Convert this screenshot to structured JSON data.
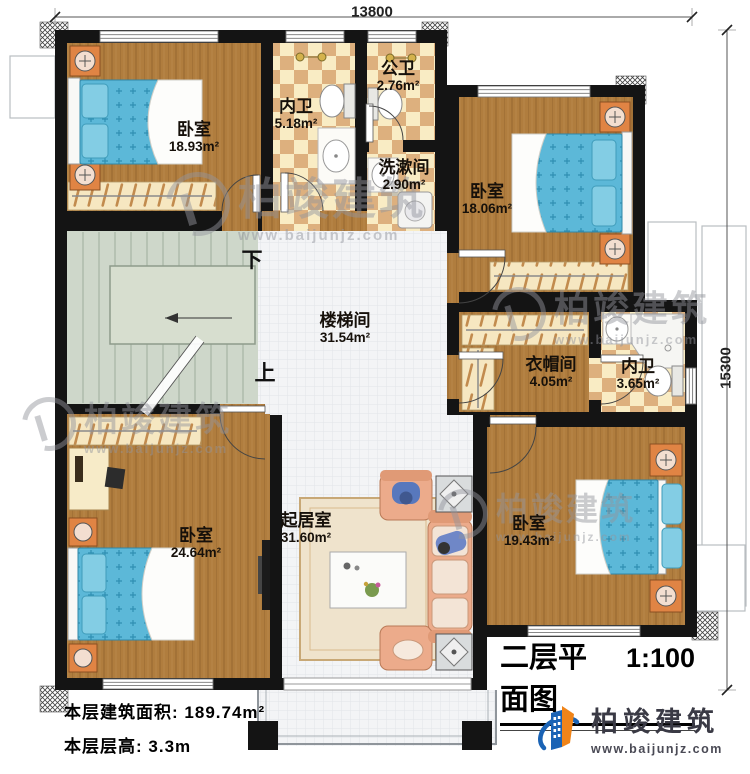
{
  "plan": {
    "title": "二层平面图",
    "scale": "1:100",
    "dimensions": {
      "width": "13800",
      "height": "15300"
    },
    "stairs": {
      "down": "下",
      "up": "上"
    },
    "rooms": [
      {
        "name": "卧室",
        "area": "18.93m²"
      },
      {
        "name": "内卫",
        "area": "5.18m²"
      },
      {
        "name": "公卫",
        "area": "2.76m²"
      },
      {
        "name": "洗漱间",
        "area": "2.90m²"
      },
      {
        "name": "卧室",
        "area": "18.06m²"
      },
      {
        "name": "楼梯间",
        "area": "31.54m²"
      },
      {
        "name": "衣帽间",
        "area": "4.05m²"
      },
      {
        "name": "内卫",
        "area": "3.65m²"
      },
      {
        "name": "卧室",
        "area": "24.64m²"
      },
      {
        "name": "起居室",
        "area": "31.60m²"
      },
      {
        "name": "卧室",
        "area": "19.43m²"
      }
    ],
    "footer": {
      "area_label": "本层建筑面积:",
      "area_value": "189.74m²",
      "height_label": "本层层高:",
      "height_value": "3.3m"
    }
  },
  "brand": {
    "name": "柏竣建筑",
    "website": "www.baijunjz.com"
  },
  "watermark": {
    "name": "柏竣建筑",
    "website": "www.baijunjz.com"
  },
  "colors": {
    "wall": "#141414",
    "wood_floor": "#b07d3e",
    "tile_checker_light": "#f9ecc4",
    "tile_checker_dark": "#ddb07e",
    "stair_floor": "#ced7ca",
    "hall_tile": "#f3f4f6",
    "bed": "#5cb8d8",
    "nightstand": "#e08444",
    "sofa": "#ecab8b",
    "brand_blue": "#1a63b5",
    "brand_orange": "#f08419"
  }
}
